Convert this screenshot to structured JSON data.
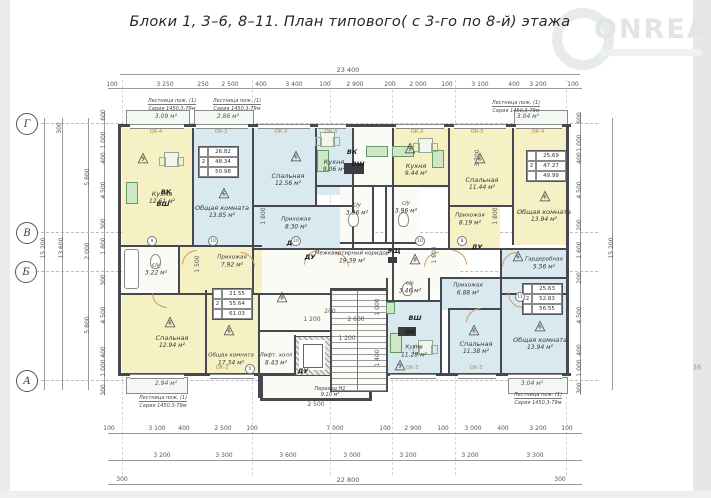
{
  "title": "Блоки 1,  3–6, 8–11.    План типового( с 3-го по 8-й) этажа",
  "watermark": {
    "brand": "ONREALT"
  },
  "sheet_note": "36",
  "axes": {
    "g": "Г",
    "v": "В",
    "b": "Б",
    "a": "А"
  },
  "labels": {
    "vk": "ВК",
    "vsh": "ВШ",
    "du": "ДУ",
    "esh": "ЭЩ",
    "ok3": "ОК-3",
    "ok4": "ОК-4"
  },
  "marks": {
    "m5": "5",
    "m6": "6",
    "m8": "8",
    "m9": "9",
    "m10": "10",
    "m11": "11"
  },
  "fire_ladder": {
    "line1": "Лестница пож. (1)",
    "line2": "Серия 1450.3-79м"
  },
  "rooms": {
    "k1": {
      "name": "Кухня",
      "area": "12.61 м²"
    },
    "lv1": {
      "name": "Общая комната",
      "area": "13.85 м²"
    },
    "bd1": {
      "name": "Спальная",
      "area": "12.56 м²"
    },
    "k2": {
      "name": "Кухня",
      "area": "9.06 м²"
    },
    "k3": {
      "name": "Кухня",
      "area": "9.44 м²"
    },
    "bd2": {
      "name": "Спальная",
      "area": "11.44 м²"
    },
    "lv2": {
      "name": "Общая комната",
      "area": "13.94 м²"
    },
    "h3": {
      "name": "Прихожая",
      "area": "8.19 м²"
    },
    "w1": {
      "name": "Гардеробная",
      "area": "5.56 м²"
    },
    "s1": {
      "name": "с/у",
      "area": "3.22 м²"
    },
    "h1": {
      "name": "Прихожая",
      "area": "7.92 м²"
    },
    "h2": {
      "name": "Прихожая",
      "area": "8.30 м²"
    },
    "s2": {
      "name": "с/у",
      "area": "3.96 м²"
    },
    "s3": {
      "name": "с/у",
      "area": "3.96 м²"
    },
    "cor": {
      "name": "Межквартирный коридор",
      "area": "19.39 м²"
    },
    "bd3": {
      "name": "Спальная",
      "area": "12.94 м²"
    },
    "lv3": {
      "name": "Общая комната",
      "area": "17.34 м²"
    },
    "k4": {
      "name": "Кухня",
      "area": "11.28 м²"
    },
    "s4": {
      "name": "с/у",
      "area": "3.46 м²"
    },
    "h4": {
      "name": "Прихожая",
      "area": "6.88 м²"
    },
    "bd4": {
      "name": "Спальная",
      "area": "11.38 м²"
    },
    "lv4": {
      "name": "Общая комната",
      "area": "13.94 м²"
    }
  },
  "core": {
    "lift_hall_name": "Лифт. холл",
    "lift_hall_area": "8.43 м²",
    "perekhod_name": "Переход Н1",
    "perekhod_area": "9.10 м²"
  },
  "balconies": {
    "b1": "3.09 м²",
    "b2": "2.86 м²",
    "b3": "3.04 м²",
    "b4": "2.94 м²",
    "b5": "3.04 м²"
  },
  "stamps": {
    "t1": {
      "rooms": "2",
      "living": "26.82",
      "total": "48.34",
      "extended": "50.98"
    },
    "t2": {
      "rooms": "2",
      "living": "25.69",
      "total": "47.27",
      "extended": "49.99"
    },
    "t3": {
      "rooms": "2",
      "living": "21.55",
      "total": "55.64",
      "extended": "61.03"
    },
    "t4": {
      "rooms": "2",
      "living": "25.63",
      "total": "52.83",
      "extended": "56.55"
    }
  },
  "dims": {
    "top_total": "23 400",
    "top_chain": [
      "100",
      "3 250",
      "250",
      "2 500",
      "400",
      "3 400",
      "100",
      "2 900",
      "200",
      "2 000",
      "100",
      "3 100",
      "400",
      "3 200",
      "100"
    ],
    "bottom_chain_1": [
      "100",
      "3 100",
      "400",
      "2 500",
      "100",
      "7 000",
      "100",
      "2 900",
      "100",
      "3 000",
      "400",
      "3 200",
      "100"
    ],
    "bottom_chain_2": [
      "3 200",
      "3 300",
      "3 600",
      "3 000",
      "3 200",
      "3 200",
      "3 300"
    ],
    "bottom_total": "22 800",
    "edge": "300",
    "left_chain": [
      "5 800",
      "2 000",
      "5 800"
    ],
    "left_inner": [
      "600",
      "1 000",
      "400",
      "4 500",
      "300",
      "1 800",
      "300",
      "4 500",
      "400",
      "1 000",
      "300"
    ],
    "left_total": "15 200",
    "left_total_inner": "13 600",
    "right_inner": [
      "600",
      "1 000",
      "400",
      "4 500",
      "200",
      "1 600",
      "200",
      "4 500",
      "400",
      "1 000",
      "300"
    ],
    "right_total": "15 200",
    "inner": [
      "2 600",
      "1 200",
      "200",
      "1 200",
      "1 400",
      "1 000",
      "2 500",
      "3 700",
      "1 800",
      "1 800",
      "1 600",
      "1 500"
    ]
  }
}
